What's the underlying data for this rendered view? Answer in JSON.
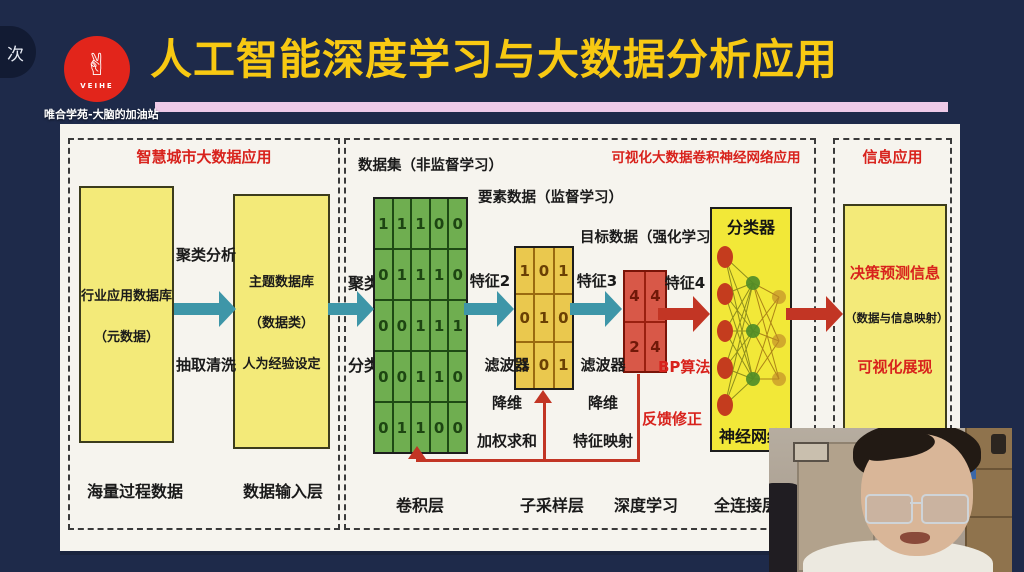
{
  "chrome": {
    "corner_tab": "次",
    "watermark": "唯合学苑-大脑的加油站"
  },
  "logo": {
    "brand": "VEIHE",
    "hand_icon": "✌"
  },
  "header": {
    "title": "人工智能深度学习与大数据分析应用"
  },
  "smart_city": {
    "title": "智慧城市大数据应用",
    "db_box": {
      "line1": "行业应用数据库",
      "line2": "（元数据）"
    },
    "theme_box": {
      "line1": "主题数据库",
      "line2": "（数据类）",
      "line3": "人为经验设定"
    },
    "arrow_label_top": "聚类分析",
    "arrow_label_bottom": "抽取清洗",
    "caption_left": "海量过程数据",
    "caption_right": "数据输入层"
  },
  "cnn": {
    "title": "可视化大数据卷积神经网络应用",
    "dataset_label": "数据集（非监督学习）",
    "element_label": "要素数据（监督学习）",
    "target_label": "目标数据（强化学习）",
    "cluster_label": "聚类",
    "classify_label": "分类",
    "feature2": "特征2",
    "feature3": "特征3",
    "feature4": "特征4",
    "filter1": {
      "l1": "滤波器",
      "l2": "降维",
      "l3": "加权求和"
    },
    "filter2": {
      "l1": "滤波器",
      "l2": "降维",
      "l3": "特征映射"
    },
    "bp_label": "BP算法",
    "feedback_label": "反馈修正",
    "classifier_title": "分类器",
    "classifier_caption": "神经网络",
    "captions": [
      "卷积层",
      "子采样层",
      "深度学习",
      "全连接层"
    ]
  },
  "matrices": {
    "green": [
      [
        1,
        1,
        1,
        0,
        0
      ],
      [
        0,
        1,
        1,
        1,
        0
      ],
      [
        0,
        0,
        1,
        1,
        1
      ],
      [
        0,
        0,
        1,
        1,
        0
      ],
      [
        0,
        1,
        1,
        0,
        0
      ]
    ],
    "yellow": [
      [
        1,
        0,
        1
      ],
      [
        0,
        1,
        0
      ],
      [
        1,
        0,
        1
      ]
    ],
    "red": [
      [
        4,
        4
      ],
      [
        2,
        4
      ]
    ]
  },
  "info": {
    "title": "信息应用",
    "line1": "决策预测信息",
    "line2": "（数据与信息映射）",
    "line3": "可视化展现"
  },
  "colors": {
    "red": "#d8221c",
    "teal": "#3e96a8",
    "arrow_red": "#c23524",
    "slide_yellow": "#f3ea79",
    "title_yellow": "#f8c912",
    "pink": "#eecae8",
    "navy": "#1e2a4a"
  }
}
